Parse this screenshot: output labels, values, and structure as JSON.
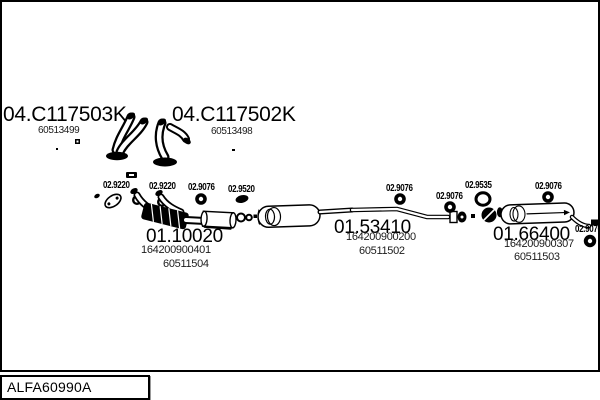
{
  "diagram": {
    "code_box": "ALFA60990A",
    "parts": [
      {
        "code": "04.C117503K",
        "numbers": [
          "60513499"
        ]
      },
      {
        "code": "04.C117502K",
        "numbers": [
          "60513498"
        ]
      },
      {
        "code": "01.10020",
        "numbers": [
          "164200900401",
          "60511504"
        ]
      },
      {
        "code": "01.53410",
        "numbers": [
          "164200900200",
          "60511502"
        ]
      },
      {
        "code": "01.66400",
        "numbers": [
          "164200900307",
          "60511503"
        ]
      }
    ],
    "fittings": [
      {
        "code": "02.9220"
      },
      {
        "code": "02.9220"
      },
      {
        "code": "02.9076"
      },
      {
        "code": "02.9520"
      },
      {
        "code": "02.9076"
      },
      {
        "code": "02.9076"
      },
      {
        "code": "02.9535"
      },
      {
        "code": "02.9076"
      },
      {
        "code": "02.9076"
      }
    ],
    "colors": {
      "line": "#000000",
      "background": "#ffffff"
    }
  }
}
